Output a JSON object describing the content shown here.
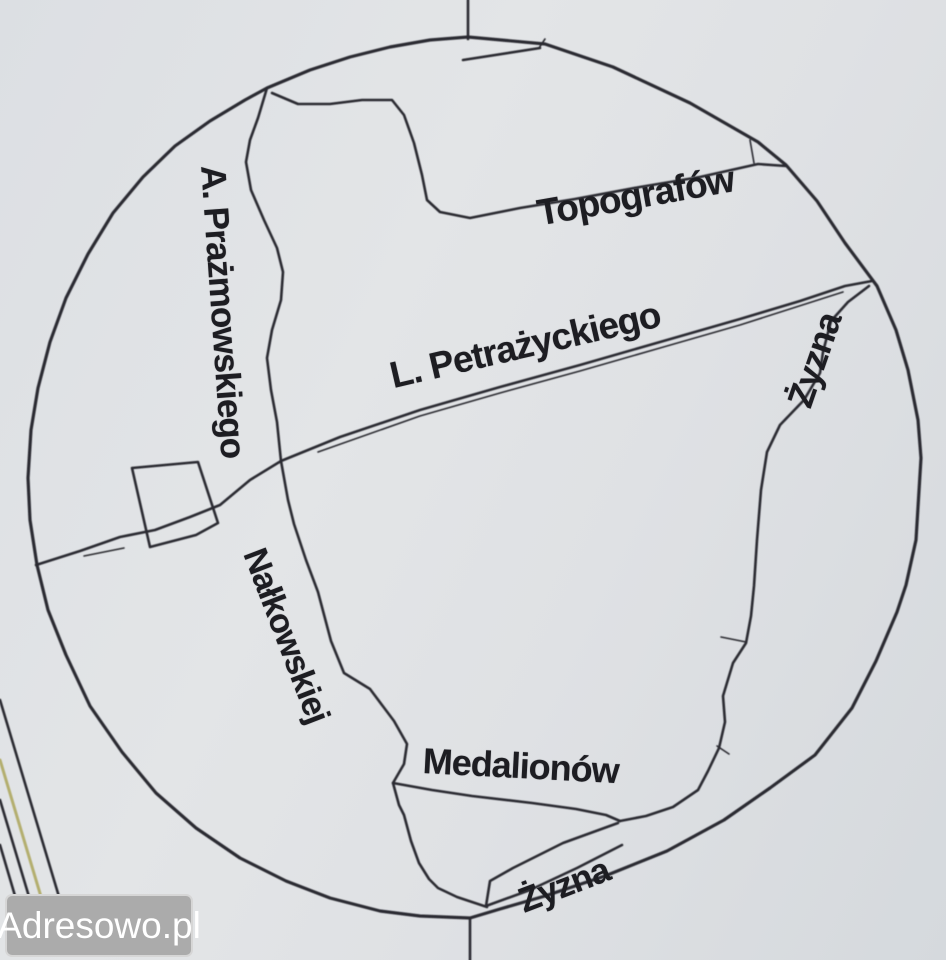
{
  "page": {
    "kind": "scanned street-map sketch",
    "paper_light": "#e3e5e7",
    "paper_dark": "#d5d9dd",
    "ink": "#2b2b31",
    "label_ink": "#1d1d22",
    "railway_accent": "#b3ae6e"
  },
  "watermark": {
    "label": "Adresowo.pl",
    "background": "#ababab",
    "border": "#d6d6d6",
    "text_color": "#ffffff"
  },
  "map": {
    "boundary": "hand-drawn circular outline",
    "features": {
      "plot_rectangle": "small quadrilateral parcel on west side",
      "railway_lines": "bundle of parallel diagonal lines in bottom-left corner",
      "tick_marks": "short crossing ticks on top and bottom of circle"
    },
    "streets": [
      {
        "name": "Topografów"
      },
      {
        "name": "L. Petrażyckiego"
      },
      {
        "name": "A. Prażmowskiego"
      },
      {
        "name": "Żyzna"
      },
      {
        "name": "Nałkowskiej"
      },
      {
        "name": "Medalionów"
      },
      {
        "name": "Żyzna"
      }
    ]
  }
}
